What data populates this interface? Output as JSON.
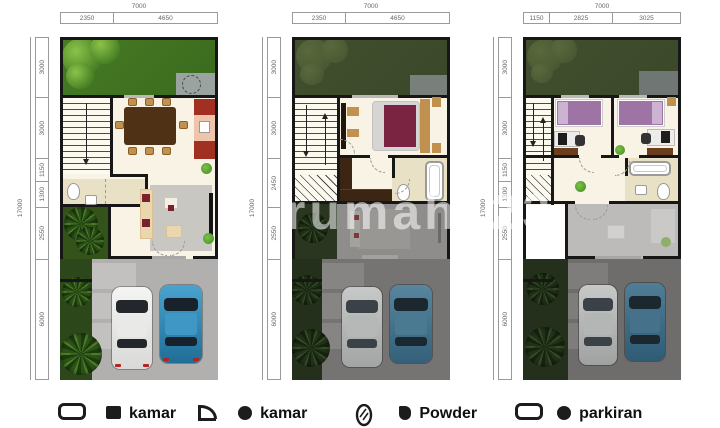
{
  "watermark": {
    "text": "rumah123"
  },
  "plans": [
    {
      "id": "floor-1",
      "top_total": "7000",
      "top_segments": [
        "2350",
        "4650"
      ],
      "left_total": "17000",
      "left_segments": [
        "3000",
        "3000",
        "1150",
        "1300",
        "2550",
        "6000"
      ]
    },
    {
      "id": "floor-2",
      "top_total": "7000",
      "top_segments": [
        "2350",
        "4650"
      ],
      "left_total": "17000",
      "left_segments": [
        "3000",
        "3000",
        "2450",
        "2550",
        "6000"
      ]
    },
    {
      "id": "floor-3",
      "top_total": "7000",
      "top_segments": [
        "1150",
        "2825",
        "3025"
      ],
      "left_total": "17000",
      "left_segments": [
        "3000",
        "3000",
        "1150",
        "1300",
        "2550",
        "6000"
      ]
    }
  ],
  "legend": {
    "items": [
      {
        "icon": "bathtub-icon",
        "label": ""
      },
      {
        "icon": "bed-icon",
        "label": "kamar"
      },
      {
        "icon": "door-icon",
        "label": ""
      },
      {
        "icon": "shower-icon",
        "label": "kamar"
      },
      {
        "icon": "mirror-icon",
        "label": ""
      },
      {
        "icon": "powder-icon",
        "label": "Powder"
      },
      {
        "icon": "bathtub-icon",
        "label": ""
      },
      {
        "icon": "parking-icon",
        "label": "parkiran"
      }
    ]
  },
  "colors": {
    "grass_bright": "#417423",
    "grass_dark": "#3f4c2e",
    "driveway": "#b1b0ae",
    "driveway_dim": "#727170",
    "car_white": "#e9e9e7",
    "car_blue": "#2f86ad",
    "wall": "#171717",
    "floor_cream": "#f8f3e4",
    "bath_floor": "#e9e1c6",
    "bed_maroon": "#7b2441",
    "bed_purple": "#9d74a4",
    "wood_dark": "#4f3115",
    "wood_light": "#c0914f",
    "rug_gray": "#c9c7c2",
    "dim_line": "#9a9a9a"
  }
}
